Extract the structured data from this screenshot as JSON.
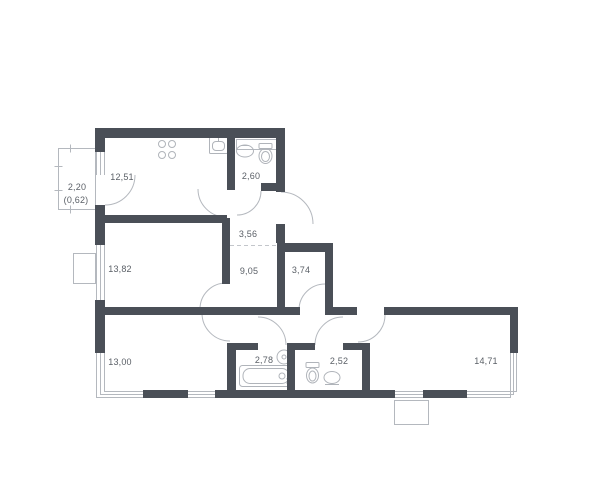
{
  "floor_plan": {
    "title": "apartment floor plan",
    "colors": {
      "wall": "#4a4f57",
      "line": "#b4b8be",
      "text": "#5a5f66",
      "background": "#ffffff"
    },
    "rooms": [
      {
        "id": "balcony",
        "area": "2,20",
        "area_secondary": "(0,62)"
      },
      {
        "id": "kitchen",
        "area": "12,51"
      },
      {
        "id": "bathroom-top",
        "area": "2,60"
      },
      {
        "id": "hall-upper",
        "area": "3,56"
      },
      {
        "id": "hall-lower",
        "area": "9,05"
      },
      {
        "id": "wardrobe",
        "area": "3,74"
      },
      {
        "id": "bedroom-left",
        "area": "13,82"
      },
      {
        "id": "bedroom-bottom",
        "area": "13,00"
      },
      {
        "id": "bathroom-bathtub",
        "area": "2,78"
      },
      {
        "id": "bathroom-wc",
        "area": "2,52"
      },
      {
        "id": "living-room",
        "area": "14,71"
      }
    ],
    "fixtures": [
      "stove-icon",
      "kitchen-sink-icon",
      "washbasin-icon",
      "toilet-icon",
      "bathtub-icon",
      "shaft-box",
      "ac-unit-box",
      "balcony-outline"
    ]
  }
}
